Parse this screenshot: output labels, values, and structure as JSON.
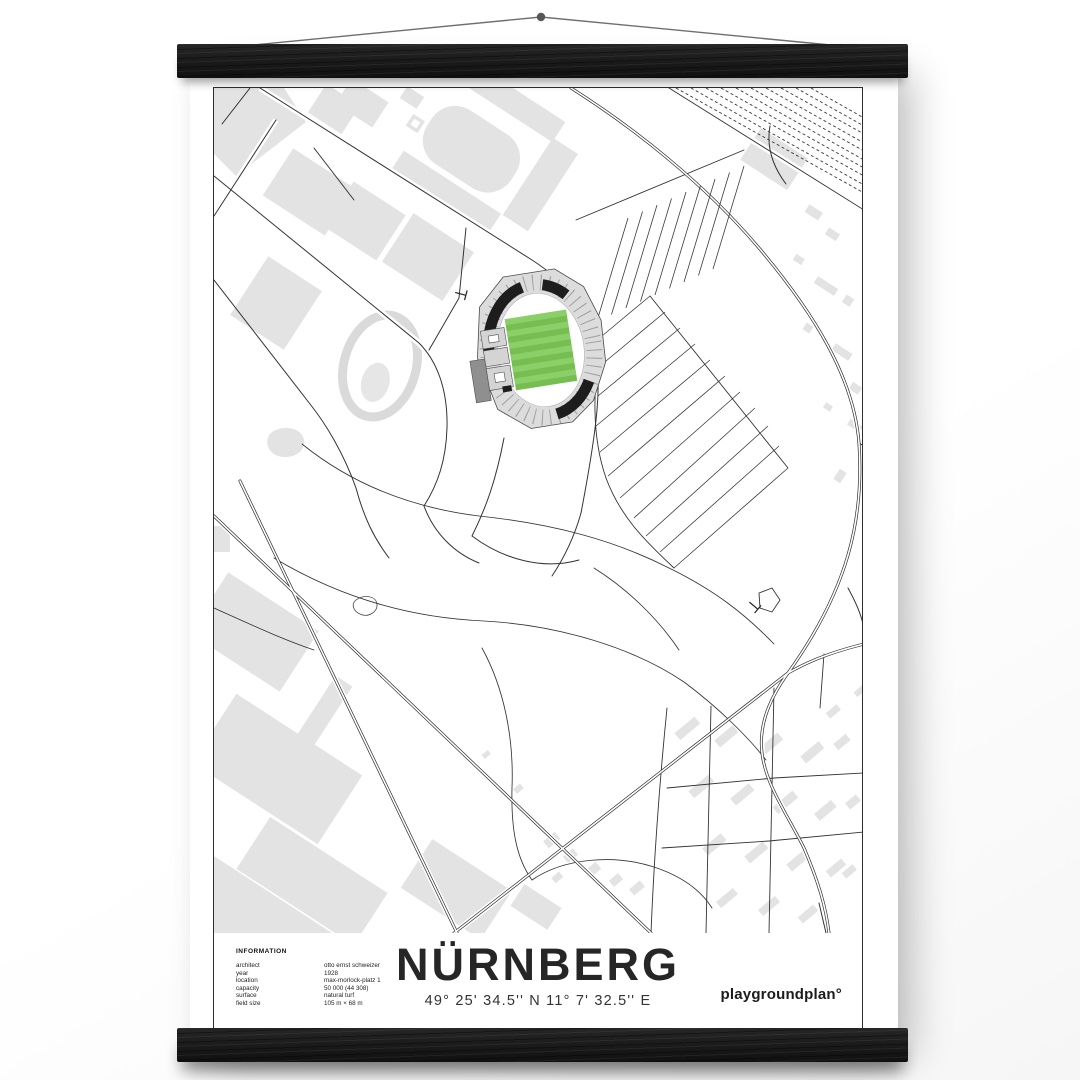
{
  "poster": {
    "title": "NÜRNBERG",
    "coordinates": "49° 25' 34.5'' N  11° 7' 32.5'' E",
    "brand": "playgroundplan°",
    "info": {
      "heading": "INFORMATION",
      "rows": [
        {
          "label": "architect",
          "value": "otto ernst schweizer"
        },
        {
          "label": "year",
          "value": "1928"
        },
        {
          "label": "location",
          "value": "max-morlock-platz 1"
        },
        {
          "label": "capacity",
          "value": "50 000 (44 308)"
        },
        {
          "label": "surface",
          "value": "natural turf"
        },
        {
          "label": "field size",
          "value": "105 m × 68 m"
        }
      ]
    },
    "map": {
      "colors": {
        "pitch_green": "#76bd52",
        "pitch_stripe": "#8bcf68",
        "building_gray": "#e3e3e3",
        "stand_black": "#1d1d1d",
        "road_line": "#333333"
      }
    }
  }
}
